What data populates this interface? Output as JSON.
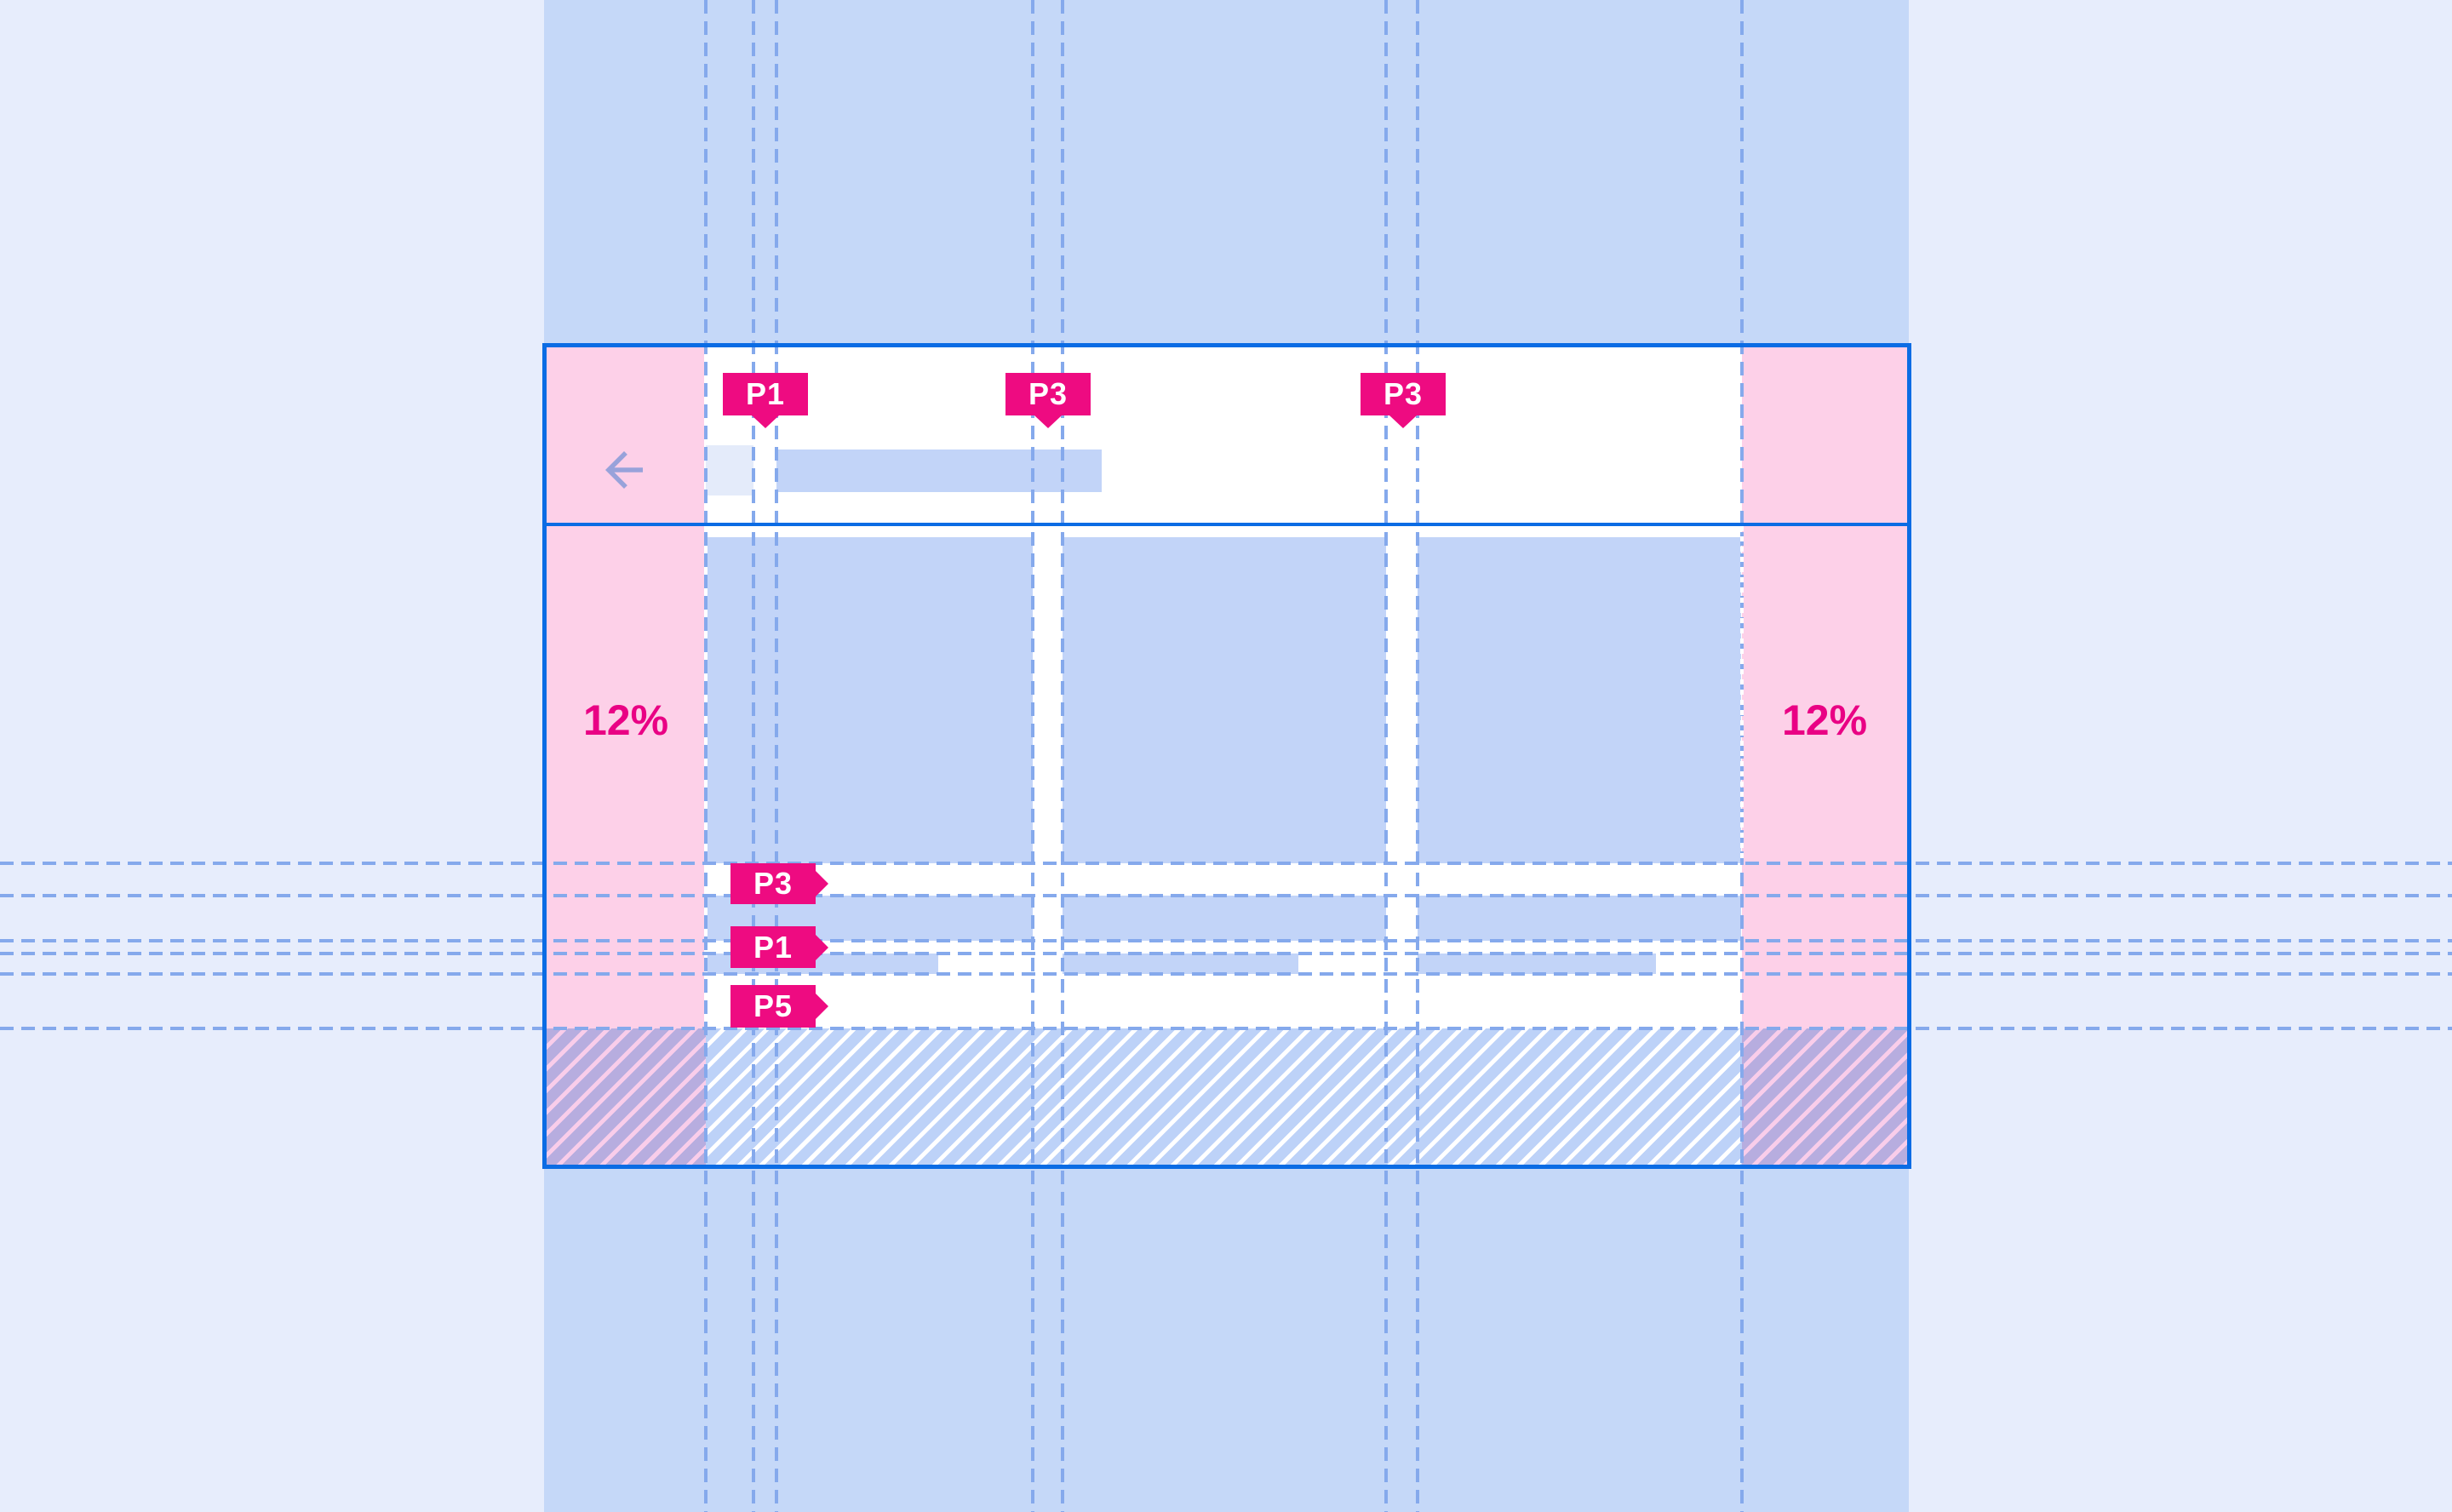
{
  "annotations": {
    "top_markers": [
      {
        "label": "P1",
        "measures": "gap between app-bar leading icon and headline"
      },
      {
        "label": "P3",
        "measures": "gutter between column 1 and column 2"
      },
      {
        "label": "P3",
        "measures": "gutter between column 2 and column 3"
      }
    ],
    "left_markers": [
      {
        "label": "P3",
        "measures": "gap between cards and first list row"
      },
      {
        "label": "P1",
        "measures": "gap between first and second list row"
      },
      {
        "label": "P5",
        "measures": "gap between list rows and bottom system area"
      }
    ],
    "margin_left_label": "12%",
    "margin_right_label": "12%"
  },
  "mockup": {
    "type": "tablet landscape layout spec",
    "app_bar": {
      "leading_icon": "back-arrow",
      "headline": "placeholder bar"
    },
    "content": {
      "columns": 3,
      "cards": 3,
      "list_rows_per_column": 2
    },
    "bottom_area": "hatched system/navigation region"
  },
  "colors": {
    "canvas": "#e7edfc",
    "band": "#c5d8f8",
    "frame": "#0b6ce4",
    "guide": "#85a9ec",
    "margin_pink": "#fdd0e8",
    "placeholder": "#c2d4f8",
    "placeholder_light": "#e4ebfa",
    "marker": "#ee0b81",
    "marker_text": "#ffffff",
    "percent": "#e90184",
    "arrow": "#98a2da",
    "hatch_bg": "#bdd2f8",
    "hatch_stripe": "#ffffff",
    "hatch_margin_bg": "#b7addf",
    "hatch_margin_stripe": "#f9cdea"
  }
}
